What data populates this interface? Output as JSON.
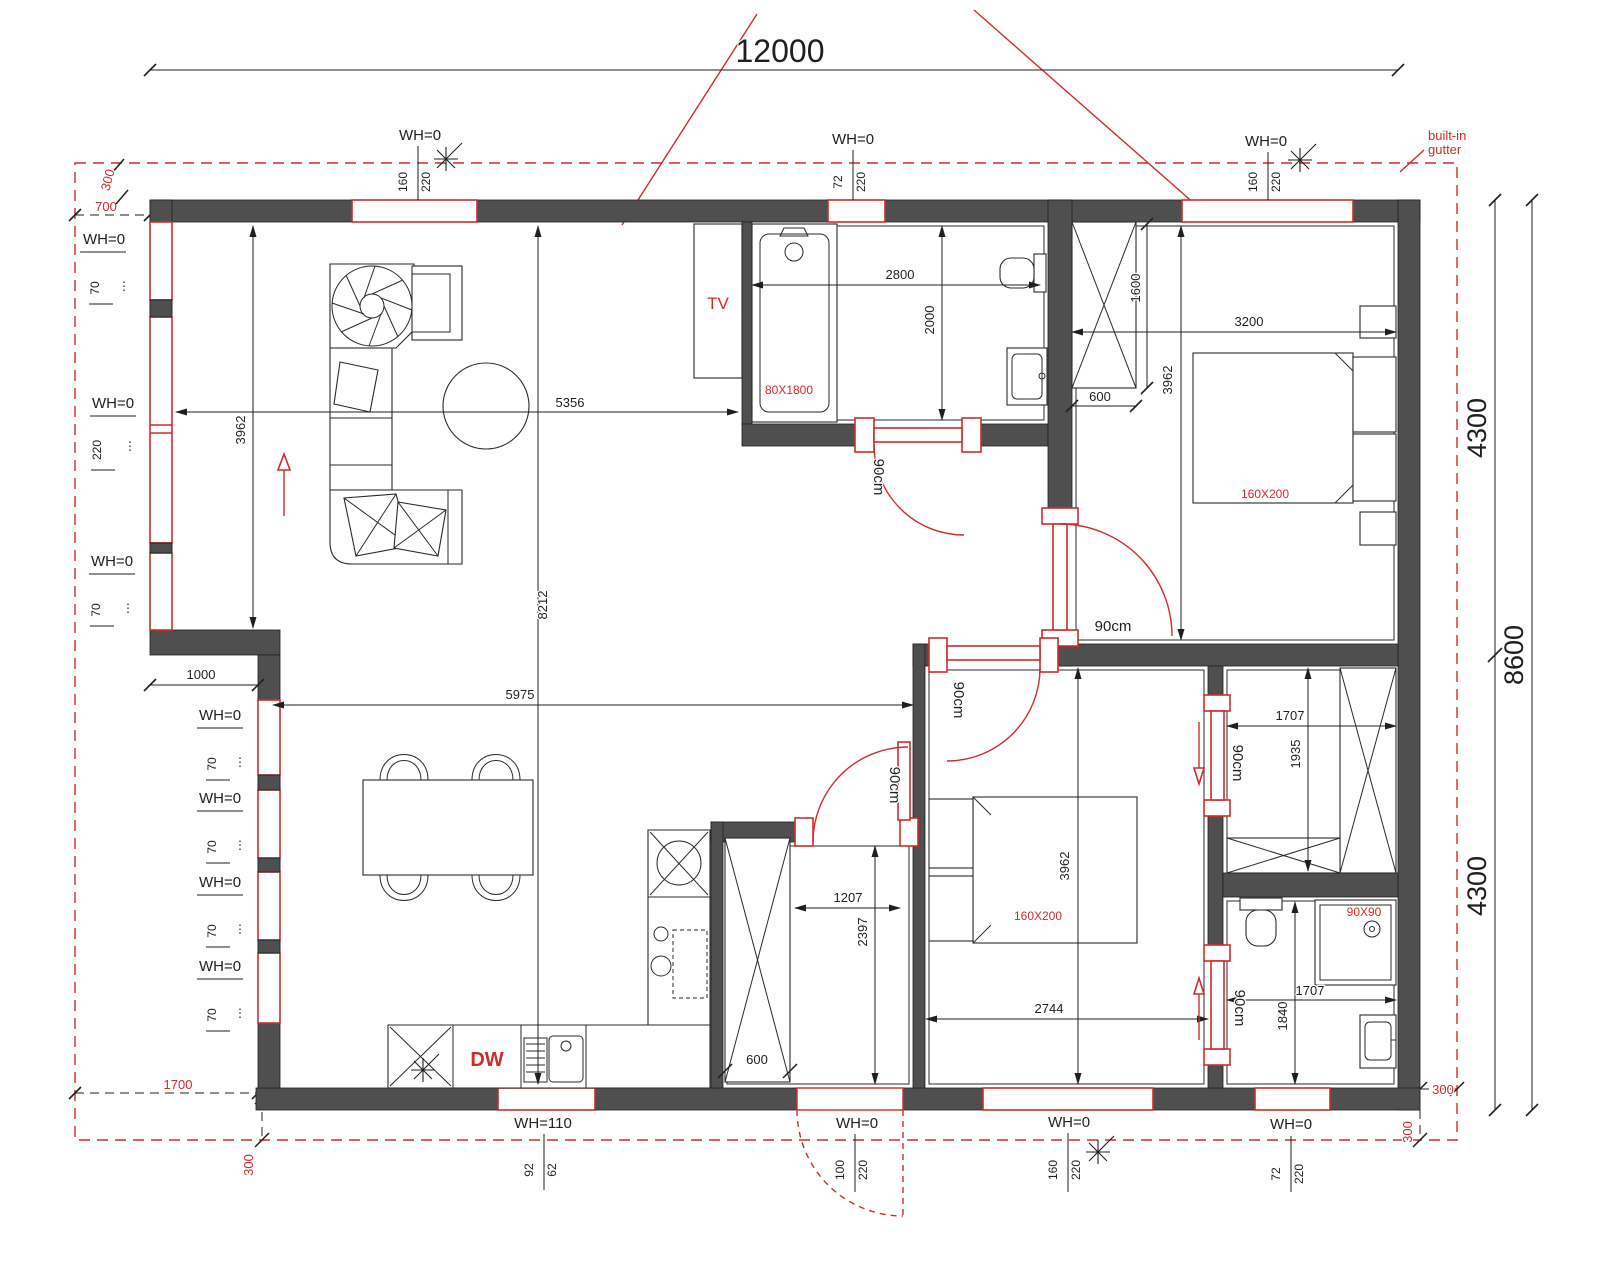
{
  "meta": {
    "type": "architectural floor plan drawing"
  },
  "colors": {
    "wall": "#4f4f4f",
    "accent_red": "#d22b2b",
    "line": "#1f1f1f",
    "background": "#ffffff"
  },
  "icons": {
    "sun": "✳",
    "ellipsis": "⋮"
  },
  "dims": {
    "overall_width": "12000",
    "right_upper": "4300",
    "right_lower": "4300",
    "right_total": "8600",
    "living_height": "3962",
    "living_width": "5356",
    "interior_height": "8212",
    "step_offset": "1000",
    "dining_width": "5975",
    "bath1_width": "2800",
    "bath1_height": "2000",
    "wardrobe1_height": "1600",
    "wardrobe1_depth": "600",
    "bed1_width": "3200",
    "bed1_room_height": "3962",
    "hall_width": "1207",
    "hall_height": "2397",
    "hall_cabinet_depth": "600",
    "bed2_width": "2744",
    "bed2_room_height": "3962",
    "closet_width": "1707",
    "closet_height": "1935",
    "bath2_height": "1840",
    "bath2_width": "1707"
  },
  "roof": {
    "note_line1": "built-in",
    "note_line2": "gutter",
    "offset_top": "300",
    "offset_left": "700",
    "offset_bottom_left": "1700",
    "offset_bottom_left_v": "300",
    "offset_bottom_right_h": "300",
    "offset_bottom_right_v": "300"
  },
  "windows": {
    "top": [
      {
        "label": "WH=0",
        "size1": "160",
        "size2": "220"
      },
      {
        "label": "WH=0",
        "size1": "72",
        "size2": "220"
      },
      {
        "label": "WH=0",
        "size1": "160",
        "size2": "220"
      }
    ],
    "left_upper": [
      {
        "label": "WH=0",
        "size1": "70"
      },
      {
        "label": "WH=0",
        "size1": "220"
      },
      {
        "label": "WH=0",
        "size1": "70"
      }
    ],
    "left_lower": [
      {
        "label": "WH=0",
        "size1": "70"
      },
      {
        "label": "WH=0",
        "size1": "70"
      },
      {
        "label": "WH=0",
        "size1": "70"
      },
      {
        "label": "WH=0",
        "size1": "70"
      }
    ],
    "bottom": [
      {
        "label": "WH=110",
        "size1": "92",
        "size2": "62"
      },
      {
        "label": "WH=0",
        "size1": "100",
        "size2": "220"
      },
      {
        "label": "WH=0",
        "size1": "160",
        "size2": "220"
      },
      {
        "label": "WH=0",
        "size1": "72",
        "size2": "220"
      }
    ]
  },
  "doors": {
    "bathroom": "90cm",
    "bedroom1": "90cm",
    "bedroom2": "90cm",
    "hall": "90cm",
    "closet_sliding": "90cm",
    "bathroom2_sliding": "90cm"
  },
  "rooms": {
    "living": {
      "tv_label": "TV"
    },
    "kitchen": {
      "dishwasher_label": "DW"
    },
    "bathroom1": {
      "bathtub_label": "80X1800"
    },
    "bedroom1": {
      "bed_label": "160X200"
    },
    "bedroom2": {
      "bed_label": "160X200"
    },
    "bathroom2": {
      "shower_label": "90X90"
    }
  }
}
